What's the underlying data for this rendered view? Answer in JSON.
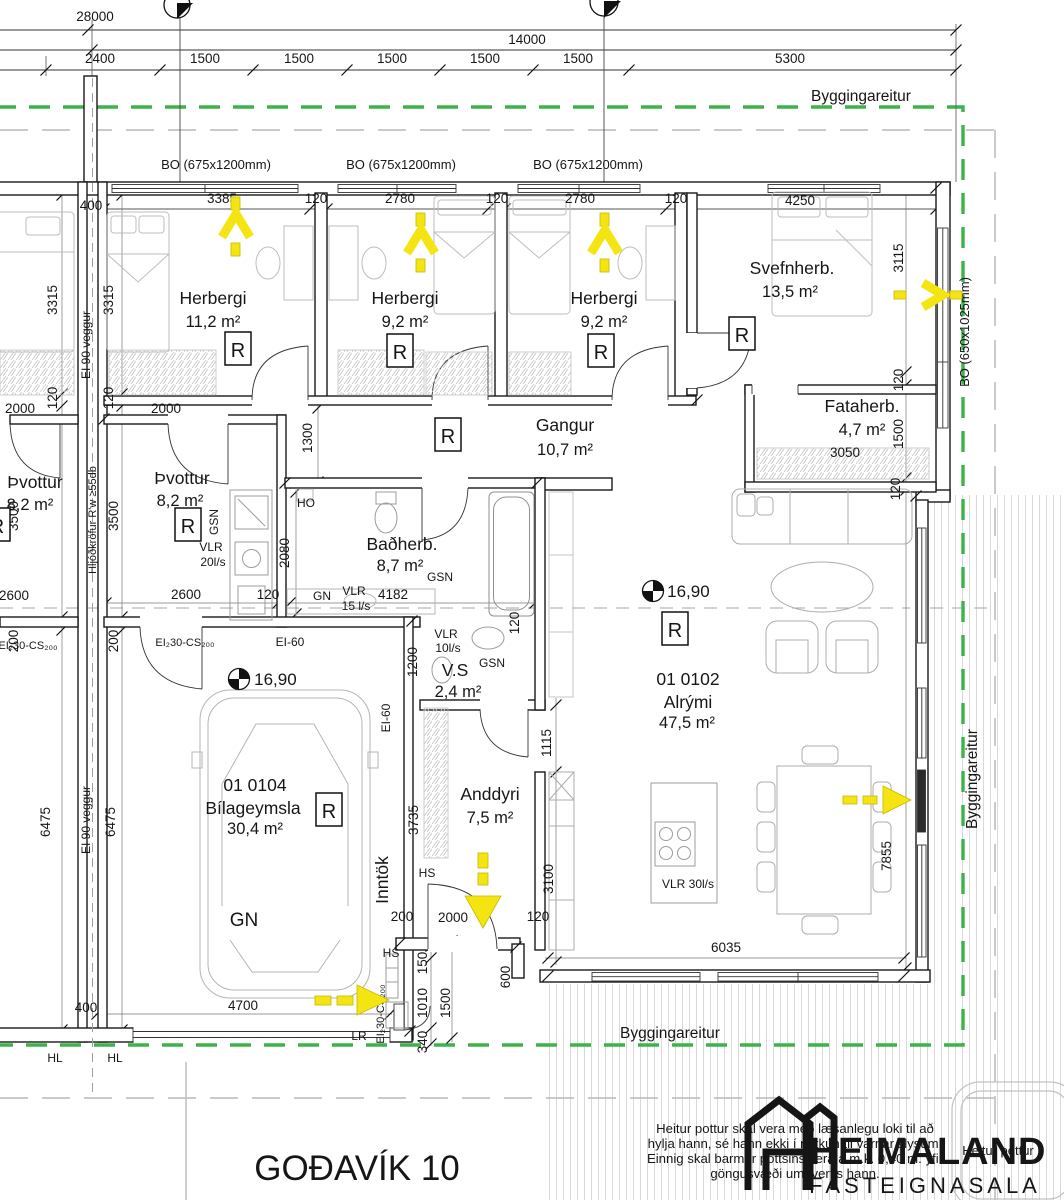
{
  "title": "GOÐAVÍK 10",
  "logo": {
    "name": "HEIMALAND",
    "tagline": "FASTEIGNASALA"
  },
  "boundary": {
    "label": "Byggingareitur"
  },
  "note": {
    "l1": "Heitur pottur skal vera með læsanlegu loki til að",
    "l2": "hylja hann, sé hann ekki í notkun til varnar slysum.",
    "l3": "Einnig skal barmur pottsins vera a.m.k. 0,40 m. yfir",
    "l4": "göngusvæði umhverfis hann."
  },
  "hot_tub_label": "Heitur pottur",
  "rooms": {
    "herbergi1": {
      "name": "Herbergi",
      "area": "11,2 m²"
    },
    "herbergi2": {
      "name": "Herbergi",
      "area": "9,2 m²"
    },
    "herbergi3": {
      "name": "Herbergi",
      "area": "9,2 m²"
    },
    "svefnherb": {
      "name": "Svefnherb.",
      "area": "13,5 m²"
    },
    "fataherb": {
      "name": "Fataherb.",
      "area": "4,7 m²"
    },
    "gangur": {
      "name": "Gangur",
      "area": "10,7 m²"
    },
    "thvottur": {
      "name": "Þvottur",
      "area": "8,2 m²"
    },
    "badherb": {
      "name": "Baðherb.",
      "area": "8,7 m²"
    },
    "vs": {
      "name": "V.S",
      "area": "2,4 m²"
    },
    "alrymi": {
      "unit": "01 0102",
      "name": "Alrými",
      "area": "47,5 m²"
    },
    "anddyri": {
      "name": "Anddyri",
      "area": "7,5 m²"
    },
    "bilageymsla": {
      "unit": "01 0104",
      "name": "Bílageymsla",
      "area": "30,4 m²"
    }
  },
  "labels": {
    "r": "R",
    "k_level": "K: 16,90",
    "gsn": "GSN",
    "gn": "GN",
    "ho": "HO",
    "hs": "HS",
    "hl": "HL",
    "lr": "LR",
    "inntok": "Inntök",
    "vlr": "VLR",
    "vlr20": "20l/s",
    "vlr15": "15 l/s",
    "vlr10": "10l/s",
    "vlr30": "VLR 30l/s"
  },
  "wall_labels": {
    "ei90": "EI 90 veggur",
    "sound": "Hljóðkröfur R'w ≥55db",
    "ei60": "EI-60",
    "ei230cs": "EI₂30-CS₂₀₀"
  },
  "windows": {
    "bo675": "BO (675x1200mm)",
    "bo650": "BO (650x1025mm)"
  },
  "dims": {
    "d28000": "28000",
    "d14000": "14000",
    "d2400": "2400",
    "d1500": "1500",
    "d5300": "5300",
    "d400": "400",
    "d3385": "3385",
    "d120": "120",
    "d2780": "2780",
    "d4250": "4250",
    "d3315": "3315",
    "d3115": "3115",
    "d2000": "2000",
    "d3500": "3500",
    "d200": "200",
    "d2600": "2600",
    "d2080": "2080",
    "d1300": "1300",
    "d4182": "4182",
    "d1200": "1200",
    "d6475": "6475",
    "d3050": "3050",
    "d6035": "6035",
    "d7855": "7855",
    "d1115": "1115",
    "d3100": "3100",
    "d3735": "3735",
    "d150": "150",
    "d1010": "1010",
    "d340": "340",
    "d600": "600",
    "d4700": "4700"
  },
  "colors": {
    "boundary_green": "#3cb44a",
    "escape_yellow": "#f4e512",
    "wall_line": "#1a1a1a"
  }
}
